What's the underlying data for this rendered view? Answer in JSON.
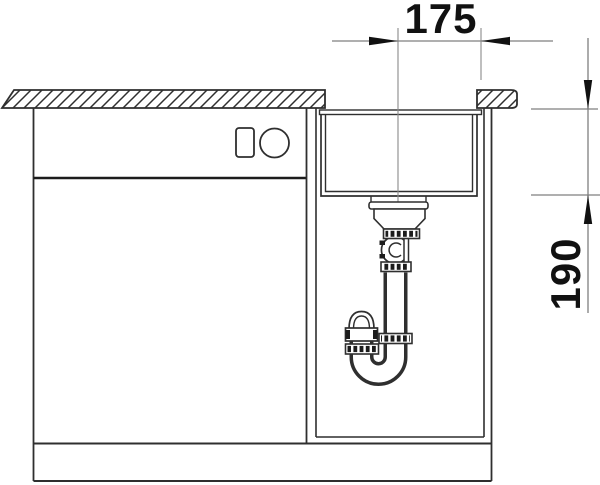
{
  "drawing": {
    "dimensions": {
      "width_mm": "175",
      "depth_mm": "190"
    },
    "colors": {
      "background": "#ffffff",
      "line": "#2f2f2f",
      "line_dark": "#1c1c1c",
      "dimension_line": "#7f7f7f",
      "dimension_text": "#111111"
    }
  }
}
